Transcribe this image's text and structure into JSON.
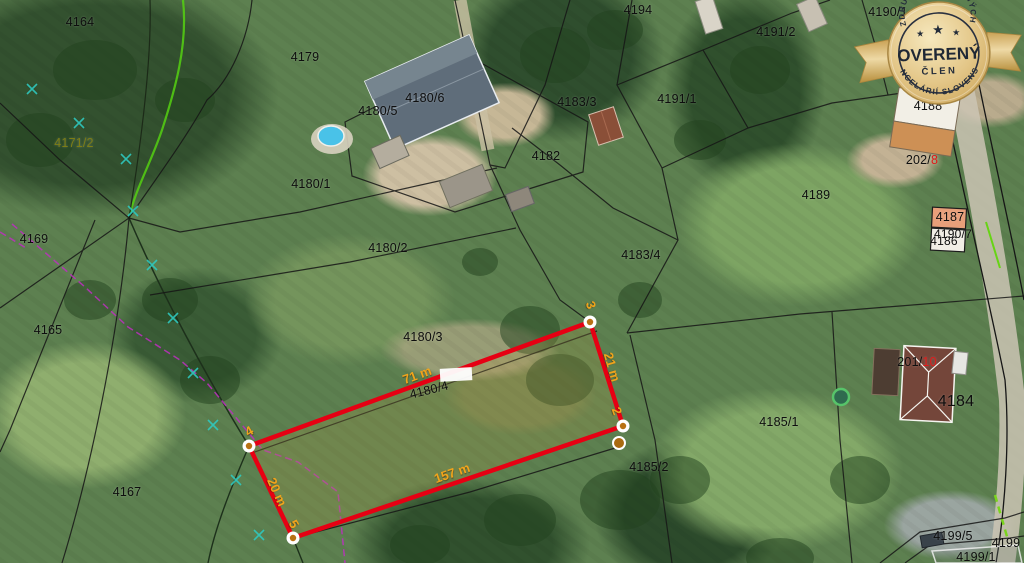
{
  "map": {
    "accent_red": "#e60013",
    "measure_color": "#f0a41c",
    "label_red": "#e01818",
    "parcels": [
      {
        "label": "4164",
        "x": 80,
        "y": 22
      },
      {
        "label": "4179",
        "x": 305,
        "y": 57
      },
      {
        "label": "4171/2",
        "x": 74,
        "y": 143,
        "color": "#7d7d15"
      },
      {
        "label": "4169",
        "x": 34,
        "y": 239
      },
      {
        "label": "4165",
        "x": 48,
        "y": 330
      },
      {
        "label": "4167",
        "x": 127,
        "y": 492
      },
      {
        "label": "4180/6",
        "x": 425,
        "y": 98
      },
      {
        "label": "4180/5",
        "x": 378,
        "y": 111
      },
      {
        "label": "4180/1",
        "x": 311,
        "y": 184
      },
      {
        "label": "4180/2",
        "x": 388,
        "y": 248
      },
      {
        "label": "4180/3",
        "x": 423,
        "y": 337
      },
      {
        "label": "4180/4",
        "x": 429,
        "y": 390,
        "rotate": -14
      },
      {
        "label": "4182",
        "x": 546,
        "y": 156
      },
      {
        "label": "4183/3",
        "x": 577,
        "y": 102
      },
      {
        "label": "4183/4",
        "x": 641,
        "y": 255
      },
      {
        "label": "4194",
        "x": 638,
        "y": 10
      },
      {
        "label": "4191/1",
        "x": 677,
        "y": 99
      },
      {
        "label": "4191/2",
        "x": 776,
        "y": 32
      },
      {
        "label": "4190/1",
        "x": 888,
        "y": 12
      },
      {
        "label": "4189",
        "x": 816,
        "y": 195
      },
      {
        "label": "4188",
        "x": 928,
        "y": 106
      },
      {
        "label": "202/",
        "label2": "8",
        "x": 922,
        "y": 160
      },
      {
        "label": "4187",
        "x": 950,
        "y": 217
      },
      {
        "label": "4190/7",
        "x": 953,
        "y": 234,
        "size": 12
      },
      {
        "label": "4186",
        "x": 944,
        "y": 241,
        "size": 12
      },
      {
        "label": "201/",
        "label2": "10",
        "x": 917,
        "y": 362
      },
      {
        "label": "4184",
        "x": 956,
        "y": 402,
        "size": 16
      },
      {
        "label": "4185/1",
        "x": 779,
        "y": 422
      },
      {
        "label": "4185/2",
        "x": 649,
        "y": 467
      },
      {
        "label": "4199/5",
        "x": 953,
        "y": 536
      },
      {
        "label": "4199",
        "x": 1006,
        "y": 543
      },
      {
        "label": "4199/1",
        "x": 976,
        "y": 557
      }
    ],
    "measurements": [
      {
        "label": "71 m",
        "x": 417,
        "y": 375,
        "rotate": -20
      },
      {
        "label": "157 m",
        "x": 452,
        "y": 473,
        "rotate": -19
      },
      {
        "label": "21 m",
        "x": 612,
        "y": 367,
        "rotate": 74
      },
      {
        "label": "20 m",
        "x": 277,
        "y": 492,
        "rotate": 66
      },
      {
        "label": "3",
        "x": 591,
        "y": 305,
        "rotate": 70
      },
      {
        "label": "2",
        "x": 617,
        "y": 411,
        "rotate": 70
      },
      {
        "label": "4",
        "x": 249,
        "y": 431,
        "rotate": -30
      },
      {
        "label": "5",
        "x": 294,
        "y": 524,
        "rotate": 60
      }
    ]
  },
  "badge": {
    "arc_top": "ZDRUŽENIE REALITNÝCH",
    "title": "OVERENÝ",
    "subtitle": "ČLEN",
    "arc_bottom": "KANCELÁRIÍ SLOVENSKA",
    "star": "★"
  }
}
